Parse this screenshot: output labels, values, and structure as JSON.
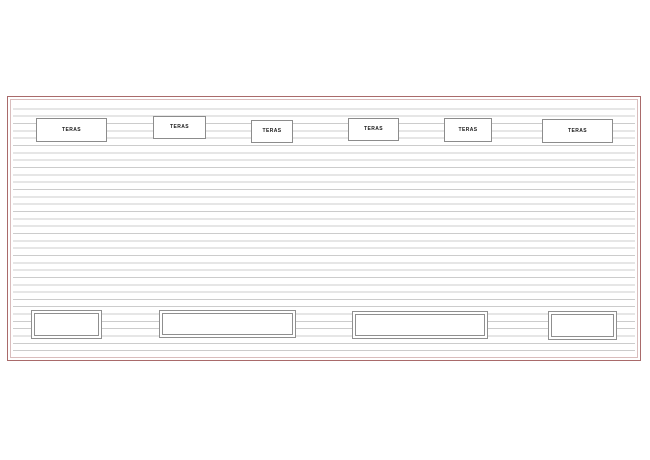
{
  "colors": {
    "border-red": "#a96a6a",
    "border-pink": "#d9bdbd",
    "siding-line": "#cccccc",
    "frame-gray": "#8f8f8f",
    "box-border": "#8c8c8c",
    "label-color": "#1a1a1a",
    "background": "#ffffff"
  },
  "top_boxes": [
    {
      "label": "TERAS"
    },
    {
      "label": "TERAS"
    },
    {
      "label": "TERAS"
    },
    {
      "label": "TERAS"
    },
    {
      "label": "TERAS"
    },
    {
      "label": "TERAS"
    }
  ]
}
